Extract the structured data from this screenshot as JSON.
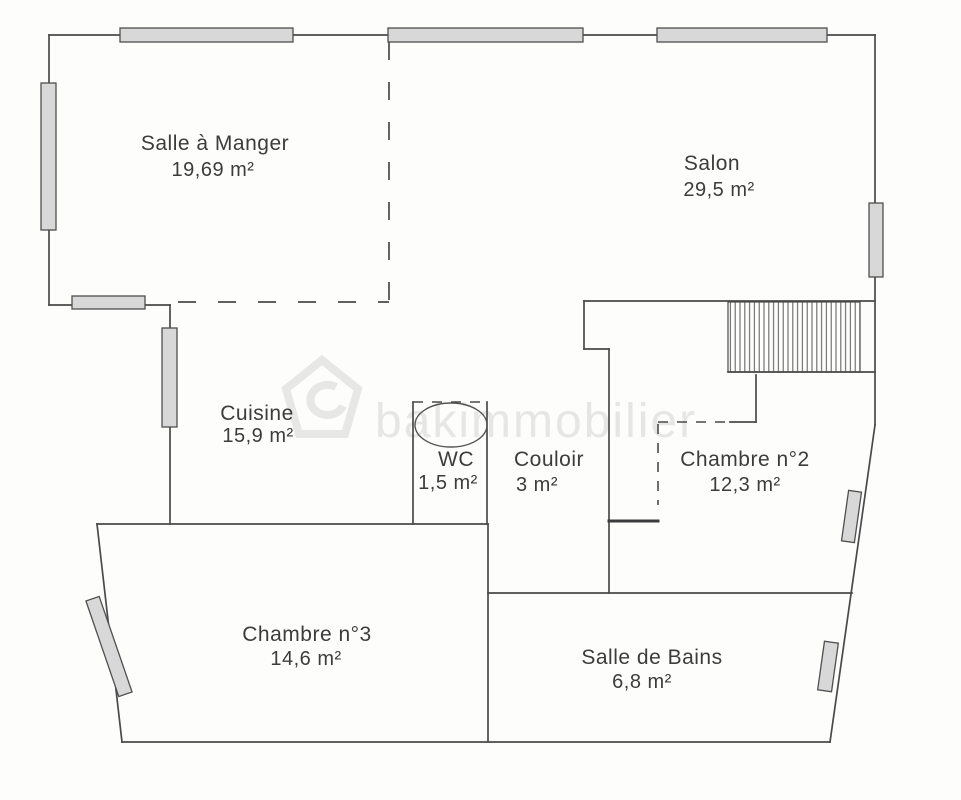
{
  "document": {
    "type": "floor-plan"
  },
  "watermark": {
    "text": "bakimmobilier",
    "logo_icon": "house-logo-icon"
  },
  "rooms": [
    {
      "id": "salle-a-manger",
      "name": "Salle à Manger",
      "area": "19,69  m²"
    },
    {
      "id": "salon",
      "name": "Salon",
      "area": "29,5  m²"
    },
    {
      "id": "cuisine",
      "name": "Cuisine",
      "area": "15,9  m²"
    },
    {
      "id": "wc",
      "name": "WC",
      "area": "1,5  m²"
    },
    {
      "id": "couloir",
      "name": "Couloir",
      "area": "3  m²"
    },
    {
      "id": "chambre-2",
      "name": "Chambre n°2",
      "area": "12,3  m²"
    },
    {
      "id": "chambre-3",
      "name": "Chambre n°3",
      "area": "14,6  m²"
    },
    {
      "id": "salle-de-bains",
      "name": "Salle de Bains",
      "area": "6,8  m²"
    }
  ],
  "colors": {
    "wall": "#4a4a4a",
    "window_fill": "#d8d8d8",
    "background": "#fdfdfc",
    "label_text": "#3c3c3c",
    "watermark": "#c4c4c4"
  }
}
